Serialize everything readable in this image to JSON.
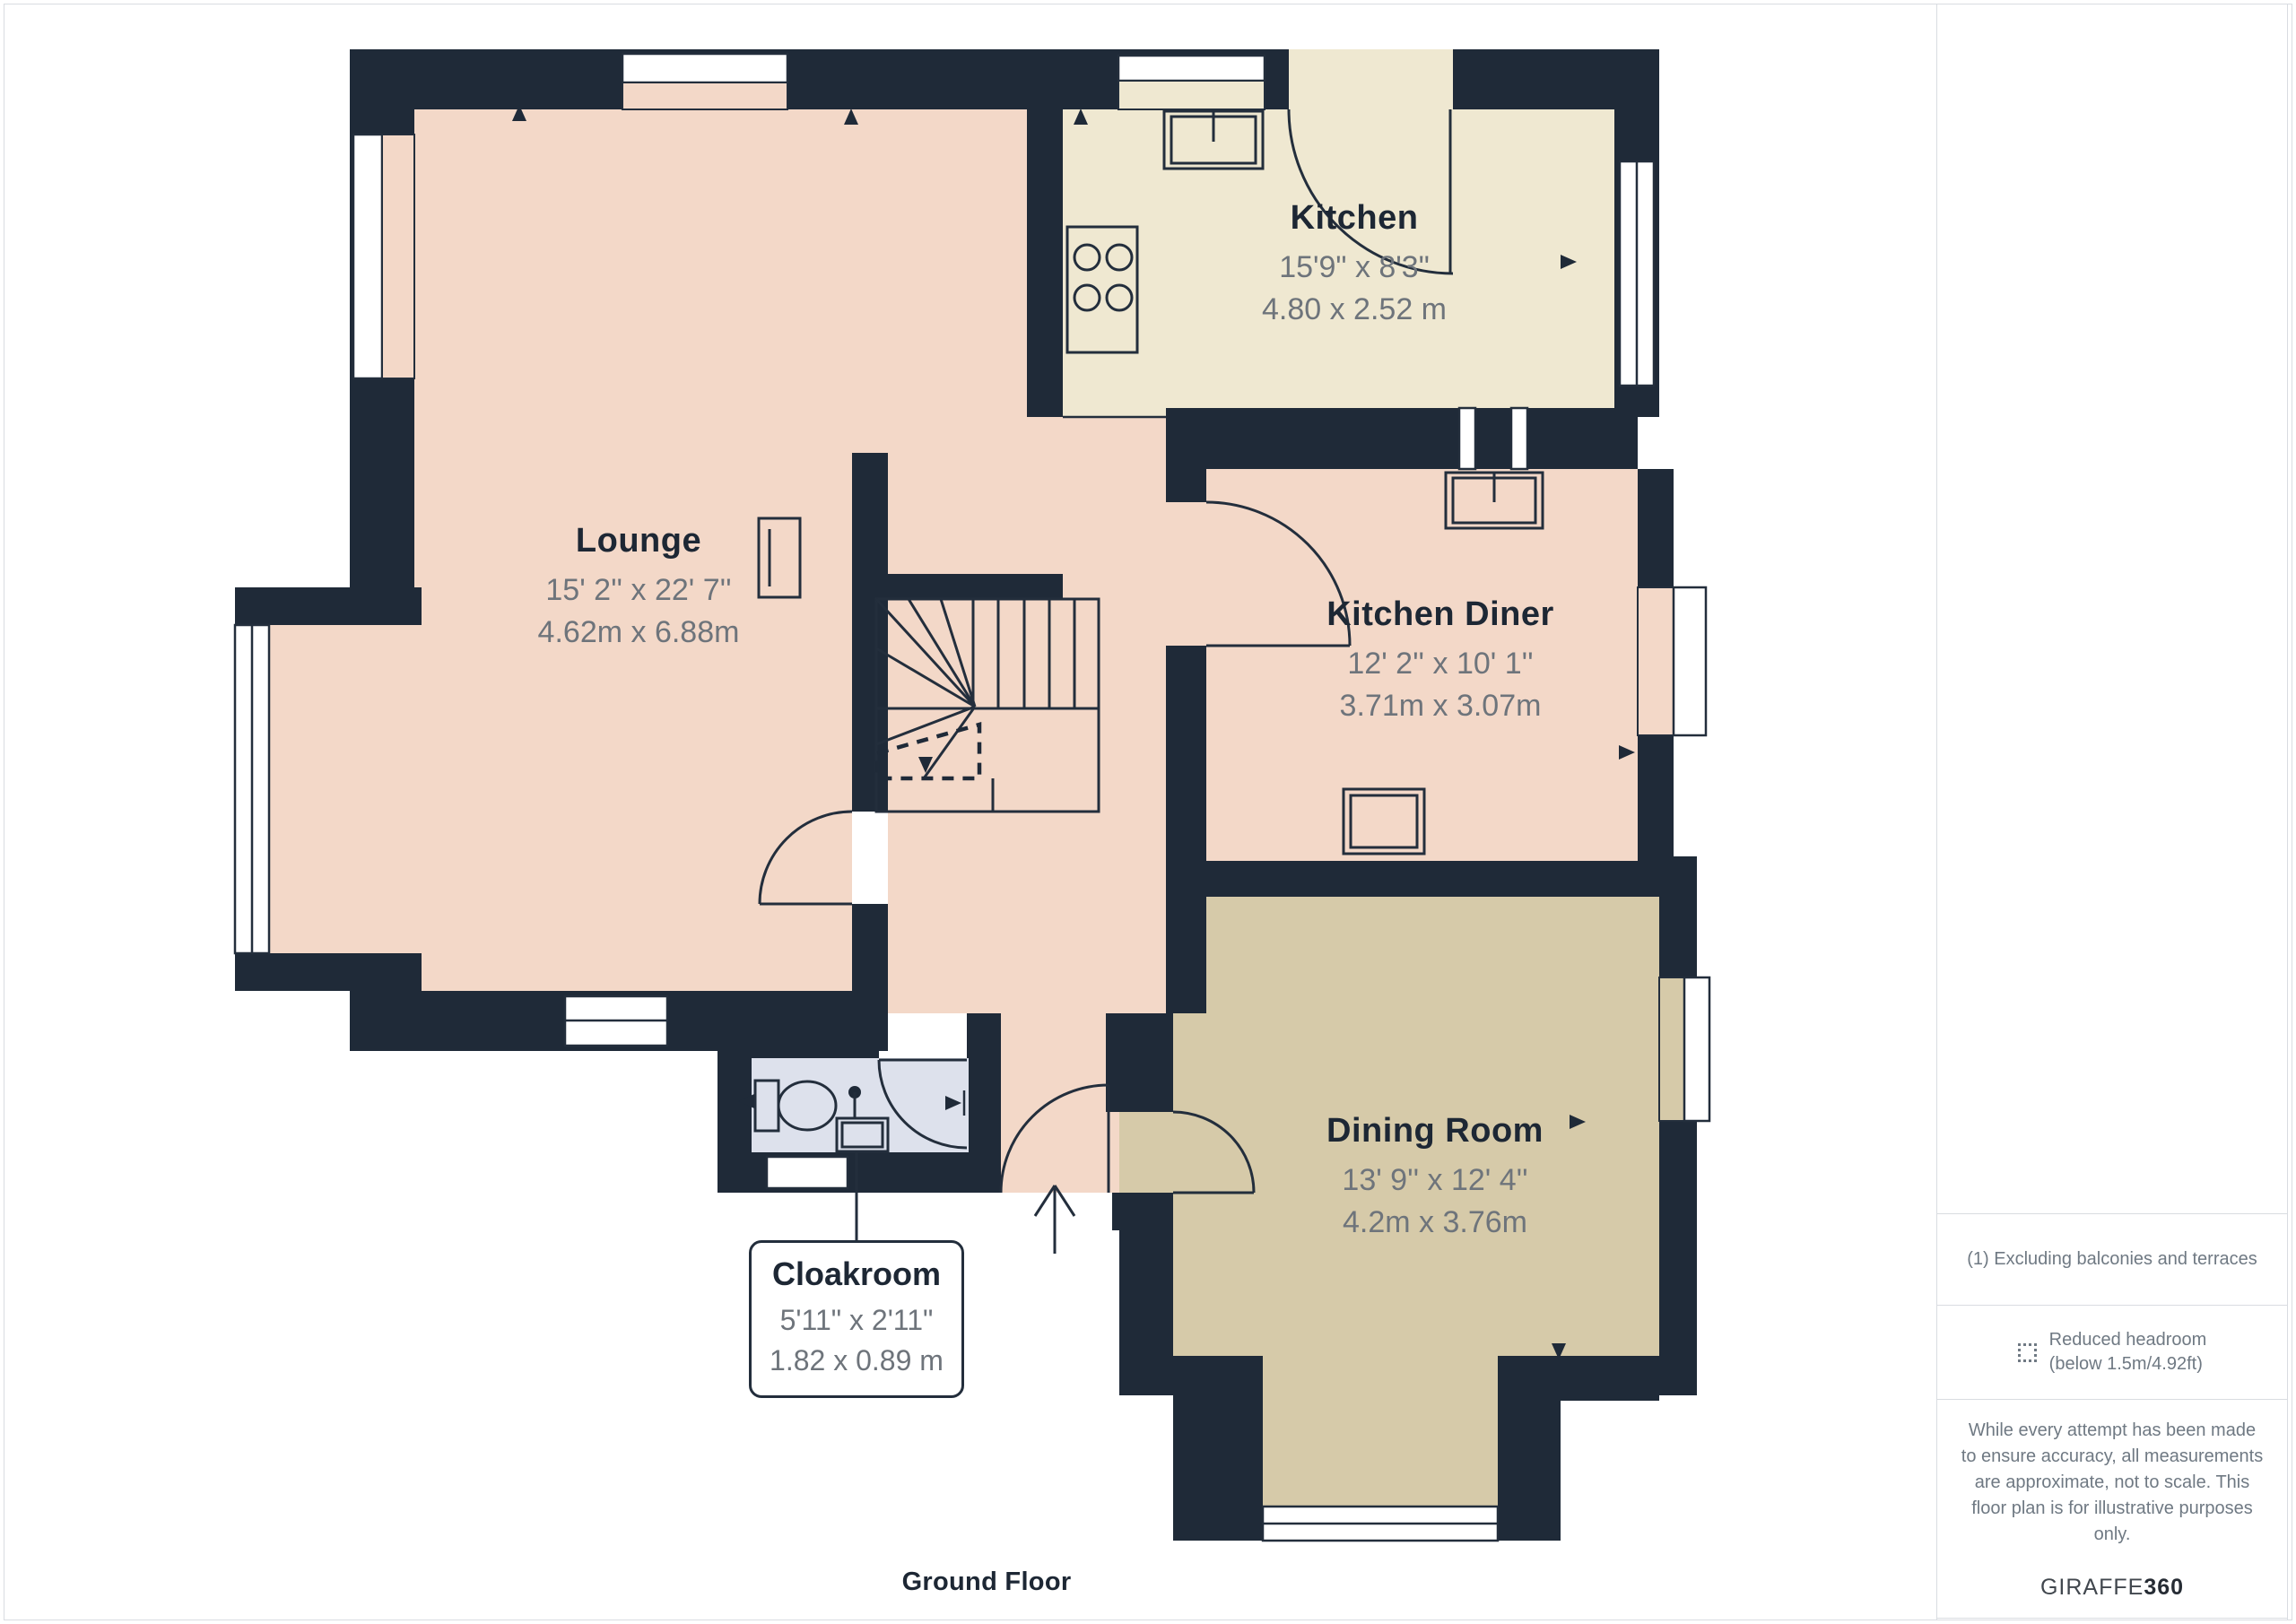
{
  "colors": {
    "wall": "#1f2a38",
    "line": "#232e3c",
    "floor_pink": "#f3d8c8",
    "floor_cream": "#efe8d1",
    "floor_tan": "#d6caa9",
    "floor_blue": "#dde1ec",
    "window": "#ffffff",
    "name_text": "#1d2734",
    "dims_text": "#6e747b",
    "sidebar_text": "#6f7983",
    "border": "#d9dce1",
    "logo_light": "#41474e",
    "logo_dark": "#262c34"
  },
  "rooms": {
    "lounge": {
      "name": "Lounge",
      "imperial": "15' 2'' x 22' 7''",
      "metric": "4.62m x 6.88m"
    },
    "kitchen": {
      "name": "Kitchen",
      "imperial": "15'9\" x 8'3\"",
      "metric": "4.80 x 2.52 m"
    },
    "kitchen_diner": {
      "name": "Kitchen Diner",
      "imperial": "12' 2'' x 10' 1''",
      "metric": "3.71m x 3.07m"
    },
    "dining_room": {
      "name": "Dining Room",
      "imperial": "13' 9'' x 12' 4''",
      "metric": "4.2m x 3.76m"
    },
    "cloakroom": {
      "name": "Cloakroom",
      "imperial": "5'11\" x 2'11\"",
      "metric": "1.82 x 0.89 m"
    }
  },
  "sidebar": {
    "note1": "(1) Excluding balconies and terraces",
    "legend": {
      "icon": "reduced-headroom-icon",
      "line1": "Reduced headroom",
      "line2": "(below 1.5m/4.92ft)"
    },
    "disclaimer": "While every attempt has been made to ensure accuracy, all measurements are approximate, not to scale. This floor plan is for illustrative purposes only.",
    "logo": {
      "part1": "GIRAFFE",
      "part2": "360"
    }
  },
  "footer": {
    "floor_label": "Ground Floor"
  }
}
